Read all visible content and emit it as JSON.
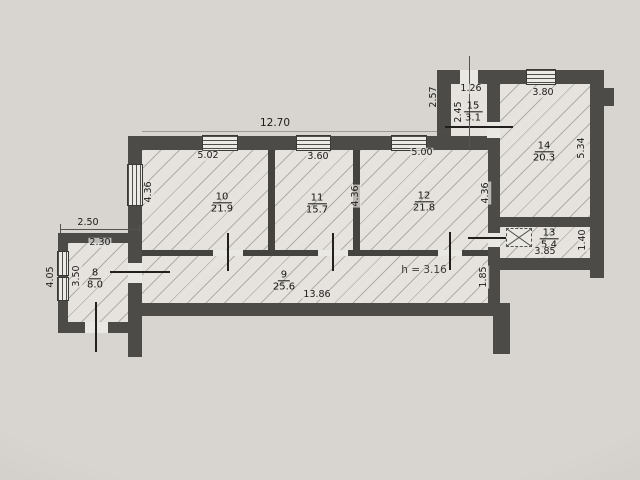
{
  "meta": {
    "type": "apartment-floor-plan",
    "ceiling_note": "h = 3.16"
  },
  "rooms": [
    {
      "num": "8",
      "area": "8.0"
    },
    {
      "num": "9",
      "area": "25.6"
    },
    {
      "num": "10",
      "area": "21.9"
    },
    {
      "num": "11",
      "area": "15.7"
    },
    {
      "num": "12",
      "area": "21.8"
    },
    {
      "num": "13",
      "area": "5.4"
    },
    {
      "num": "14",
      "area": "20.3"
    },
    {
      "num": "15",
      "area": "3.1"
    }
  ],
  "dims": {
    "total_top": "12.70",
    "w10": "5.02",
    "w11": "3.60",
    "w12": "5.00",
    "h10": "4.36",
    "h11_12": "4.36",
    "h12r": "4.36",
    "w8_out": "2.50",
    "w8_in": "2.30",
    "h8_out": "4.05",
    "h8_in": "3.50",
    "w9": "13.86",
    "h9": "1.85",
    "w13": "3.85",
    "h13": "1.40",
    "w14": "3.80",
    "h14": "5.34",
    "w15": "1.26",
    "h15": "2.45",
    "h15_out": "2.57",
    "ceiling": "h = 3.16"
  },
  "colors": {
    "paper": "#d8d4cf",
    "room_fill": "#e6e3de",
    "wall": "#4d4b48",
    "ink": "#1c1b19"
  }
}
